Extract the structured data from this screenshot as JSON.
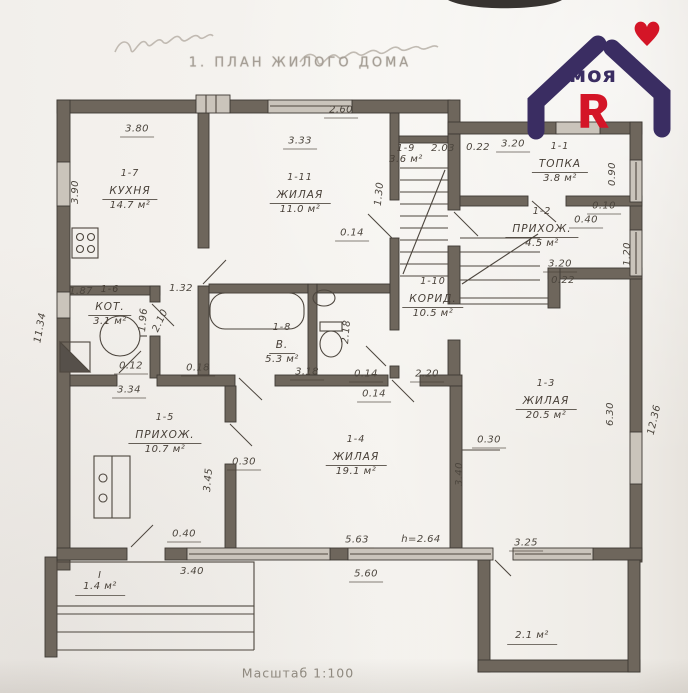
{
  "page": {
    "title": "1. ПЛАН ЖИЛОГО ДОМА",
    "scale_note": "Масштаб 1:100"
  },
  "logo": {
    "word": "моя",
    "letter": "Я",
    "purple": "#3a2d62",
    "red": "#d41527"
  },
  "rooms": [
    {
      "id": "1-7",
      "name": "КУХНЯ",
      "area": "14.7 м²",
      "x": 130,
      "y": 168
    },
    {
      "id": "1-11",
      "name": "ЖИЛАЯ",
      "area": "11.0 м²",
      "x": 300,
      "y": 172
    },
    {
      "id": "1-9",
      "name": "",
      "area": "3.6 м²",
      "x": 406,
      "y": 143
    },
    {
      "id": "1-1",
      "name": "ТОПКА",
      "area": "3.8 м²",
      "x": 560,
      "y": 141
    },
    {
      "id": "1-2",
      "name": "ПРИХОЖ.",
      "area": "4.5 м²",
      "x": 542,
      "y": 206
    },
    {
      "id": "1-3",
      "name": "ЖИЛАЯ",
      "area": "20.5 м²",
      "x": 546,
      "y": 378
    },
    {
      "id": "1-10",
      "name": "КОРИД.",
      "area": "10.5 м²",
      "x": 433,
      "y": 276
    },
    {
      "id": "1-8",
      "name": "В.",
      "area": "5.3 м²",
      "x": 282,
      "y": 322
    },
    {
      "id": "1-6",
      "name": "КОТ.",
      "area": "3.1 м²",
      "x": 110,
      "y": 284
    },
    {
      "id": "1-5",
      "name": "ПРИХОЖ.",
      "area": "10.7 м²",
      "x": 165,
      "y": 412
    },
    {
      "id": "1-4",
      "name": "ЖИЛАЯ",
      "area": "19.1 м²",
      "x": 356,
      "y": 434
    },
    {
      "id": "I",
      "name": "",
      "area": "1.4 м²",
      "x": 100,
      "y": 570,
      "ua": 1
    },
    {
      "id": "",
      "name": "",
      "area": "2.1 м²",
      "x": 532,
      "y": 630,
      "ua": 1
    }
  ],
  "dims": [
    {
      "v": "3.80",
      "x": 137,
      "y": 131,
      "u": 1
    },
    {
      "v": "2.60",
      "x": 341,
      "y": 112,
      "u": 1
    },
    {
      "v": "3.33",
      "x": 300,
      "y": 143,
      "u": 1
    },
    {
      "v": "3.90",
      "x": 76,
      "y": 192,
      "r": -90
    },
    {
      "v": "2.03",
      "x": 443,
      "y": 149
    },
    {
      "v": "0.22",
      "x": 478,
      "y": 148
    },
    {
      "v": "3.20",
      "x": 513,
      "y": 146,
      "u": 1
    },
    {
      "v": "1.30",
      "x": 380,
      "y": 194,
      "r": -84
    },
    {
      "v": "0.14",
      "x": 352,
      "y": 235,
      "u": 1
    },
    {
      "v": "0.90",
      "x": 613,
      "y": 174,
      "r": -90
    },
    {
      "v": "0.10",
      "x": 604,
      "y": 208,
      "u": 1
    },
    {
      "v": "0.40",
      "x": 586,
      "y": 222,
      "u": 1
    },
    {
      "v": "1.20",
      "x": 628,
      "y": 254,
      "r": -90
    },
    {
      "v": "3.20",
      "x": 560,
      "y": 266,
      "u": 1
    },
    {
      "v": "0.22",
      "x": 563,
      "y": 281
    },
    {
      "v": "6.30",
      "x": 611,
      "y": 414,
      "r": -90
    },
    {
      "v": "12.36",
      "x": 655,
      "y": 420,
      "r": -77
    },
    {
      "v": "3.40",
      "x": 460,
      "y": 474,
      "r": -90
    },
    {
      "v": "0.30",
      "x": 489,
      "y": 442,
      "u": 1
    },
    {
      "v": "2.20",
      "x": 427,
      "y": 376,
      "u": 1
    },
    {
      "v": "0.14",
      "x": 366,
      "y": 376,
      "u": 1
    },
    {
      "v": "0.14",
      "x": 374,
      "y": 396,
      "u": 1
    },
    {
      "v": "3.18",
      "x": 307,
      "y": 374,
      "u": 1
    },
    {
      "v": "0.18",
      "x": 198,
      "y": 370,
      "u": 1
    },
    {
      "v": "0.12",
      "x": 131,
      "y": 368,
      "u": 1
    },
    {
      "v": "3.34",
      "x": 129,
      "y": 392,
      "u": 1
    },
    {
      "v": "1.87",
      "x": 81,
      "y": 292
    },
    {
      "v": "1.32",
      "x": 181,
      "y": 289
    },
    {
      "v": "1.96",
      "x": 144,
      "y": 320,
      "r": -85
    },
    {
      "v": "2.10",
      "x": 161,
      "y": 321,
      "r": -65
    },
    {
      "v": "2.18",
      "x": 347,
      "y": 332,
      "r": -85
    },
    {
      "v": "3.45",
      "x": 209,
      "y": 480,
      "r": -85
    },
    {
      "v": "0.30",
      "x": 244,
      "y": 464,
      "u": 1
    },
    {
      "v": "0.40",
      "x": 184,
      "y": 536,
      "u": 1
    },
    {
      "v": "3.40",
      "x": 192,
      "y": 572
    },
    {
      "v": "5.63",
      "x": 357,
      "y": 542,
      "u": 1
    },
    {
      "v": "h=2.64",
      "x": 421,
      "y": 540
    },
    {
      "v": "3.25",
      "x": 526,
      "y": 545,
      "u": 1
    },
    {
      "v": "5.60",
      "x": 366,
      "y": 576,
      "u": 1
    },
    {
      "v": "11.34",
      "x": 41,
      "y": 328,
      "r": -80
    }
  ]
}
